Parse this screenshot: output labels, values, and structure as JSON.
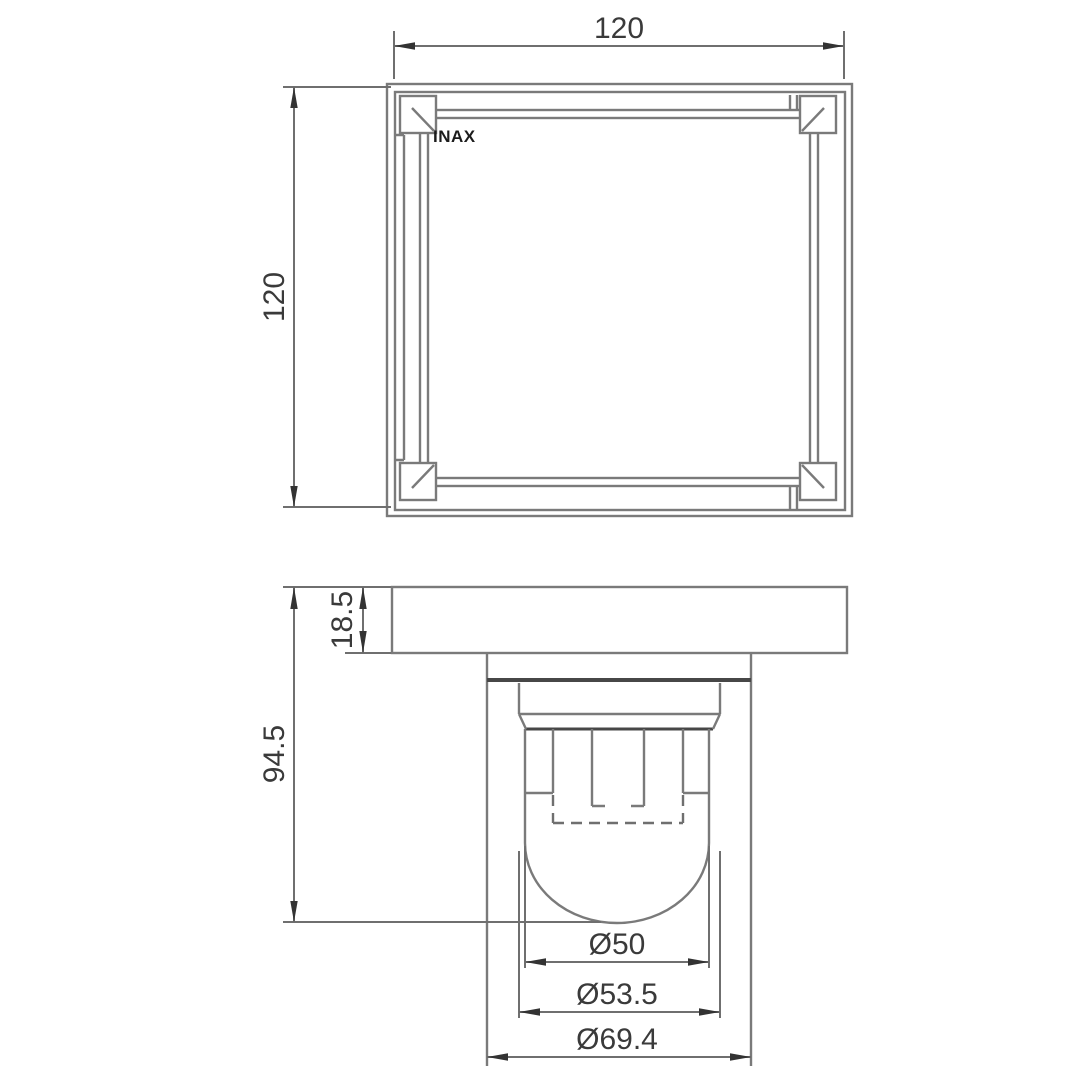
{
  "brand_label": "INAX",
  "plan_view": {
    "width_label": "120",
    "height_label": "120"
  },
  "section_view": {
    "flange_height_label": "18.5",
    "overall_height_label": "94.5",
    "inner_diameter_label": "Ø50",
    "middle_diameter_label": "Ø53.5",
    "outer_diameter_label": "Ø69.4"
  },
  "colors": {
    "background": "#ffffff",
    "line": "#7a7a7a",
    "dim_line": "#6f6f6f",
    "dark_line": "#474747",
    "arrow": "#333333",
    "text": "#3a3a3a",
    "brand": "#1c1c1c"
  }
}
